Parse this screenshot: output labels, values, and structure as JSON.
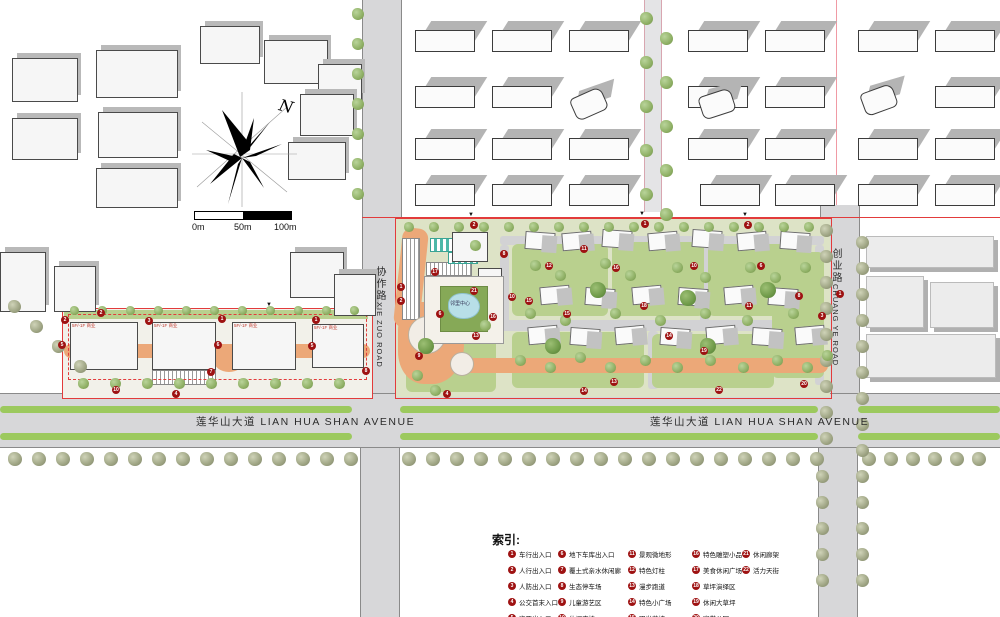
{
  "north": {
    "label": "N"
  },
  "scale_bar": {
    "labels": [
      "0m",
      "50m",
      "100m"
    ]
  },
  "roads": {
    "lianhuashan_left": "莲华山大道 LIAN HUA SHAN AVENUE",
    "lianhuashan_center": "莲华山大道 LIAN HUA SHAN AVENUE",
    "xiezuo_cn": "协作路",
    "xiezuo_en": "XIE ZUO ROAD",
    "chuangye_cn": "创业路",
    "chuangye_en": "CHUANG YE ROAD"
  },
  "site": {
    "building_label": "5F/-1F 商业",
    "neighborhood_center_label": "邻里中心"
  },
  "legend": {
    "title": "索引:",
    "columns": [
      [
        {
          "n": "1",
          "label": "车行出入口"
        },
        {
          "n": "2",
          "label": "人行出入口"
        },
        {
          "n": "3",
          "label": "人防出入口"
        },
        {
          "n": "4",
          "label": "公交首末入口"
        },
        {
          "n": "5",
          "label": "次要出入口"
        }
      ],
      [
        {
          "n": "6",
          "label": "地下车库出入口"
        },
        {
          "n": "7",
          "label": "覆土式亲水休闲廊"
        },
        {
          "n": "8",
          "label": "生态停车场"
        },
        {
          "n": "9",
          "label": "儿童游艺区"
        },
        {
          "n": "10",
          "label": "休闲座椅"
        }
      ],
      [
        {
          "n": "11",
          "label": "景观微地形"
        },
        {
          "n": "12",
          "label": "特色灯柱"
        },
        {
          "n": "13",
          "label": "漫步跑道"
        },
        {
          "n": "14",
          "label": "特色小广场"
        },
        {
          "n": "15",
          "label": "阳光草坡"
        }
      ],
      [
        {
          "n": "16",
          "label": "特色雕塑小品"
        },
        {
          "n": "17",
          "label": "美食休闲广场"
        },
        {
          "n": "18",
          "label": "草坪演绎区"
        },
        {
          "n": "19",
          "label": "休闲大草坪"
        },
        {
          "n": "20",
          "label": "宽带公园"
        }
      ],
      [
        {
          "n": "21",
          "label": "休闲廊架"
        },
        {
          "n": "22",
          "label": "活力天街"
        }
      ]
    ]
  },
  "plan_markers": [
    {
      "n": "2",
      "x": 61,
      "y": 316
    },
    {
      "n": "3",
      "x": 145,
      "y": 317
    },
    {
      "n": "1",
      "x": 218,
      "y": 315
    },
    {
      "n": "1",
      "x": 312,
      "y": 316
    },
    {
      "n": "5",
      "x": 58,
      "y": 341
    },
    {
      "n": "6",
      "x": 214,
      "y": 341
    },
    {
      "n": "5",
      "x": 308,
      "y": 342
    },
    {
      "n": "10",
      "x": 112,
      "y": 386
    },
    {
      "n": "4",
      "x": 172,
      "y": 390
    },
    {
      "n": "7",
      "x": 207,
      "y": 368
    },
    {
      "n": "8",
      "x": 362,
      "y": 367
    },
    {
      "n": "2",
      "x": 97,
      "y": 309
    },
    {
      "n": "2",
      "x": 470,
      "y": 221
    },
    {
      "n": "1",
      "x": 641,
      "y": 220
    },
    {
      "n": "2",
      "x": 744,
      "y": 221
    },
    {
      "n": "8",
      "x": 500,
      "y": 250
    },
    {
      "n": "17",
      "x": 431,
      "y": 268
    },
    {
      "n": "1",
      "x": 397,
      "y": 283
    },
    {
      "n": "2",
      "x": 397,
      "y": 297
    },
    {
      "n": "6",
      "x": 436,
      "y": 310
    },
    {
      "n": "9",
      "x": 415,
      "y": 352
    },
    {
      "n": "4",
      "x": 443,
      "y": 390
    },
    {
      "n": "16",
      "x": 489,
      "y": 313
    },
    {
      "n": "13",
      "x": 472,
      "y": 332
    },
    {
      "n": "21",
      "x": 470,
      "y": 287
    },
    {
      "n": "10",
      "x": 508,
      "y": 293
    },
    {
      "n": "12",
      "x": 545,
      "y": 262
    },
    {
      "n": "15",
      "x": 563,
      "y": 310
    },
    {
      "n": "11",
      "x": 580,
      "y": 245
    },
    {
      "n": "16",
      "x": 612,
      "y": 264
    },
    {
      "n": "10",
      "x": 690,
      "y": 262
    },
    {
      "n": "18",
      "x": 640,
      "y": 302
    },
    {
      "n": "14",
      "x": 665,
      "y": 332
    },
    {
      "n": "19",
      "x": 700,
      "y": 347
    },
    {
      "n": "11",
      "x": 745,
      "y": 302
    },
    {
      "n": "8",
      "x": 795,
      "y": 292
    },
    {
      "n": "6",
      "x": 757,
      "y": 262
    },
    {
      "n": "3",
      "x": 818,
      "y": 312
    },
    {
      "n": "20",
      "x": 800,
      "y": 380
    },
    {
      "n": "22",
      "x": 715,
      "y": 386
    },
    {
      "n": "13",
      "x": 610,
      "y": 378
    },
    {
      "n": "14",
      "x": 580,
      "y": 387
    },
    {
      "n": "15",
      "x": 525,
      "y": 297
    },
    {
      "n": "1",
      "x": 836,
      "y": 290
    }
  ],
  "colors": {
    "boundary_red": "#e23b3b",
    "survey_pink": "#f09aa4",
    "marker_red": "#9e1212",
    "path_orange": "#eca878",
    "median_green": "#9cc95e",
    "lawn_green": "#b9d08e",
    "road_gray": "#d7d7d9",
    "pond_blue": "#b8dfe8"
  }
}
